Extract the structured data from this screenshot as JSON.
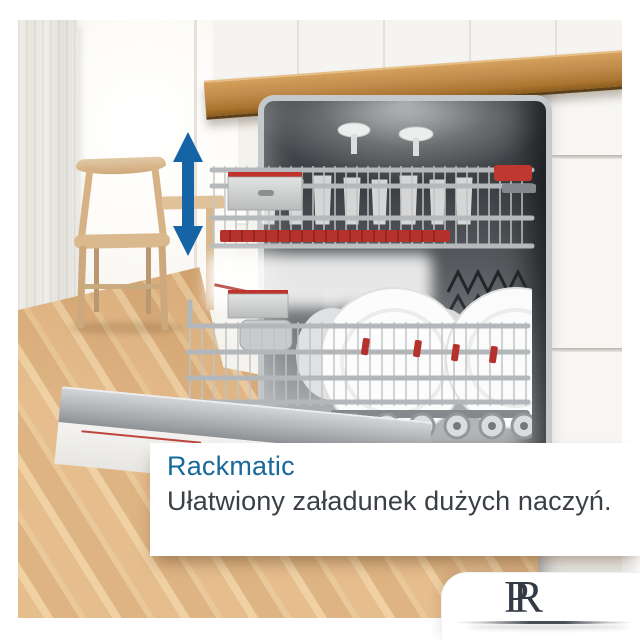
{
  "caption": {
    "title": "Rackmatic",
    "subtitle": "Ułatwiony załadunek dużych naczyń."
  },
  "logo": {
    "letter_left": "P",
    "letter_right": "R"
  },
  "icons": {
    "height_adjust_arrow": "vertical-double-arrow-icon",
    "logo_underline": "swoosh-underline"
  },
  "colors": {
    "title_blue": "#18699B",
    "subtitle_gray": "#3A4045",
    "arrow_blue": "#1464A6",
    "clip_red": "#B5322C",
    "countertop_wood": "#C08A4B",
    "floor_wood": "#D9A872",
    "monogram_dark": "#333A46",
    "background_white": "#FFFFFF"
  },
  "scene": {
    "subject": "built-in dishwasher with two extended racks, plates and glasses",
    "setting": "kitchen with wooden floor, wooden chair and white cabinets"
  }
}
